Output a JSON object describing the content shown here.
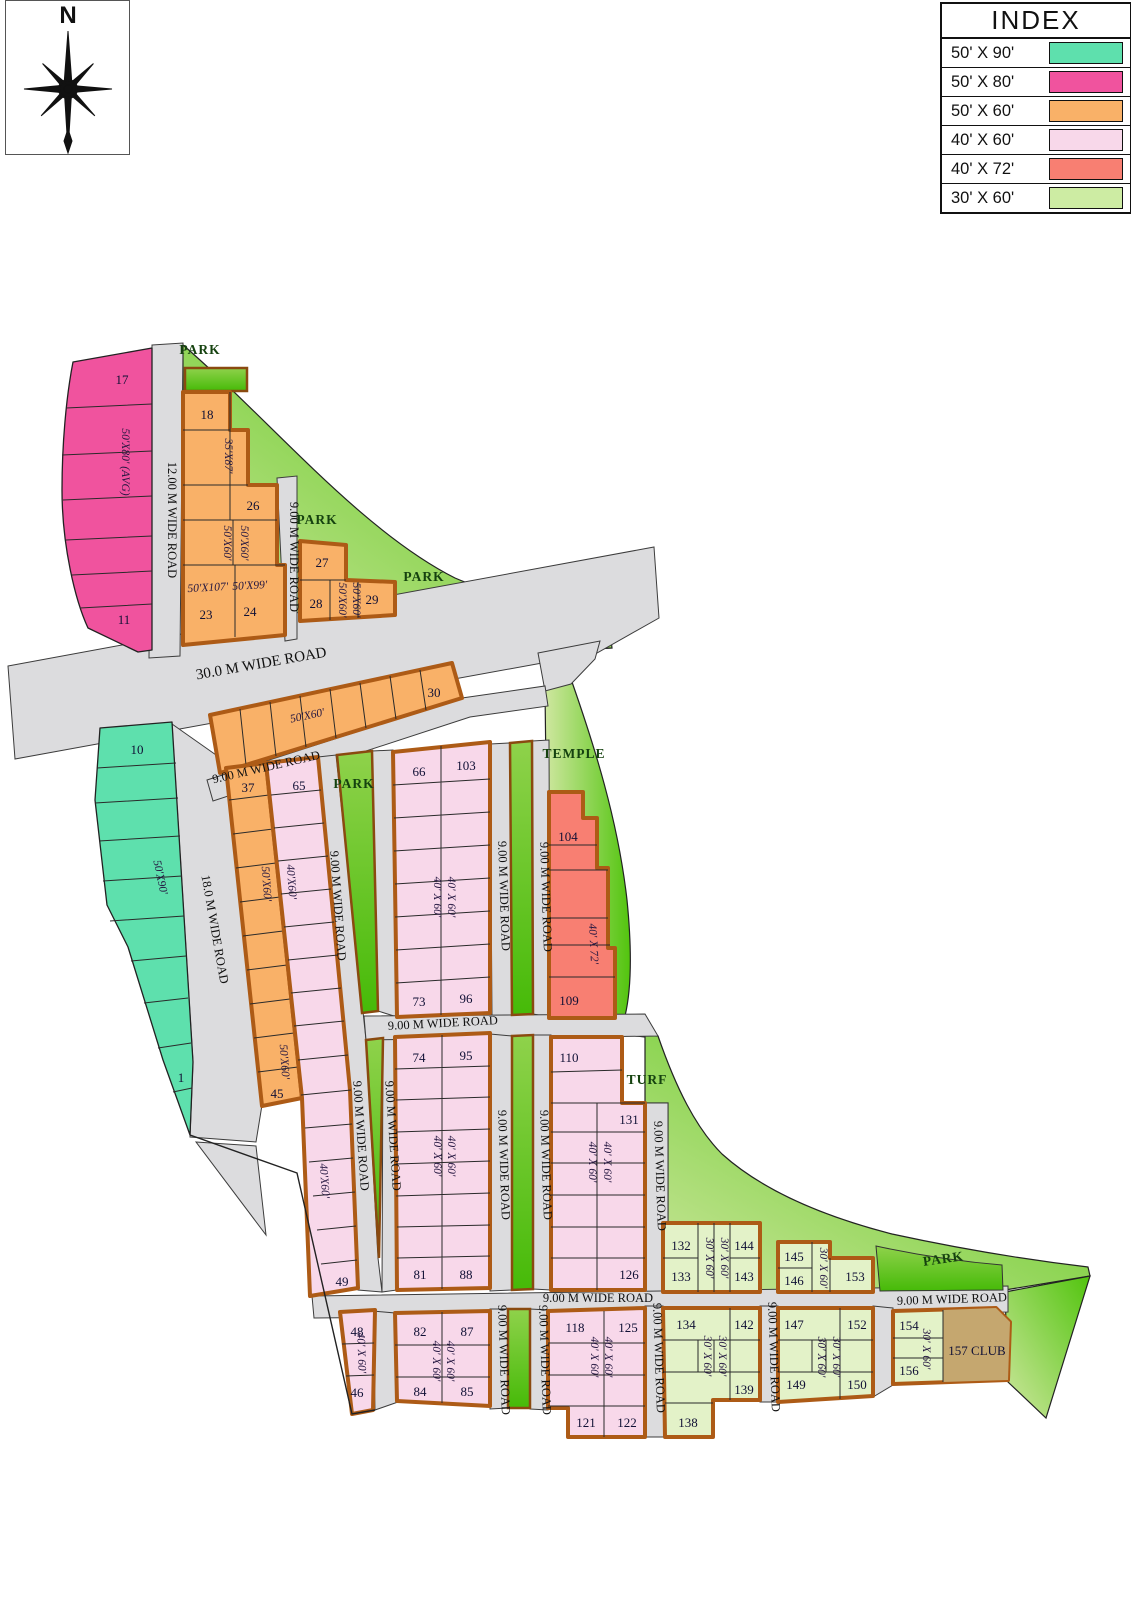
{
  "compass": {
    "label": "N"
  },
  "index": {
    "title": "INDEX",
    "items": [
      {
        "size": "50' X 90'",
        "color": "#5ee0ad"
      },
      {
        "size": "50' X 80'",
        "color": "#f0539e"
      },
      {
        "size": "50' X 60'",
        "color": "#f9b168"
      },
      {
        "size": "40' X 60'",
        "color": "#f8d8ea"
      },
      {
        "size": "40' X 72'",
        "color": "#f87f72"
      },
      {
        "size": "30' X 60'",
        "color": "#cdeca3"
      }
    ]
  },
  "roads": {
    "r30": "30.0 M WIDE ROAD",
    "r18": "18.0 M WIDE ROAD",
    "r12": "12.00 M WIDE ROAD",
    "r9": "9.00 M WIDE ROAD"
  },
  "areas": {
    "park": "PARK",
    "temple": "TEMPLE",
    "turf": "TURF"
  },
  "sizes": {
    "s5080": "50'X80' (AVG)",
    "s3587": "35'X87'",
    "s5060": "50'X60'",
    "s50107": "50'X107'",
    "s5099": "50'X99'",
    "s5090": "50'X90'",
    "s4060": "40'X60'",
    "s4060sp": "40' X 60'",
    "s4072": "40' X 72'",
    "s3060": "30' X 60'"
  },
  "plots": {
    "p1": "1",
    "p10": "10",
    "p11": "11",
    "p17": "17",
    "p18": "18",
    "p23": "23",
    "p24": "24",
    "p26": "26",
    "p27": "27",
    "p28": "28",
    "p29": "29",
    "p30": "30",
    "p37": "37",
    "p45": "45",
    "p46": "46",
    "p48": "48",
    "p49": "49",
    "p65": "65",
    "p66": "66",
    "p73": "73",
    "p74": "74",
    "p81": "81",
    "p82": "82",
    "p84": "84",
    "p85": "85",
    "p87": "87",
    "p88": "88",
    "p95": "95",
    "p96": "96",
    "p103": "103",
    "p104": "104",
    "p109": "109",
    "p110": "110",
    "p118": "118",
    "p121": "121",
    "p122": "122",
    "p125": "125",
    "p126": "126",
    "p131": "131",
    "p132": "132",
    "p133": "133",
    "p134": "134",
    "p138": "138",
    "p139": "139",
    "p142": "142",
    "p143": "143",
    "p144": "144",
    "p145": "145",
    "p146": "146",
    "p147": "147",
    "p149": "149",
    "p150": "150",
    "p152": "152",
    "p153": "153",
    "p154": "154",
    "p156": "156",
    "p157": "157 CLUB"
  }
}
